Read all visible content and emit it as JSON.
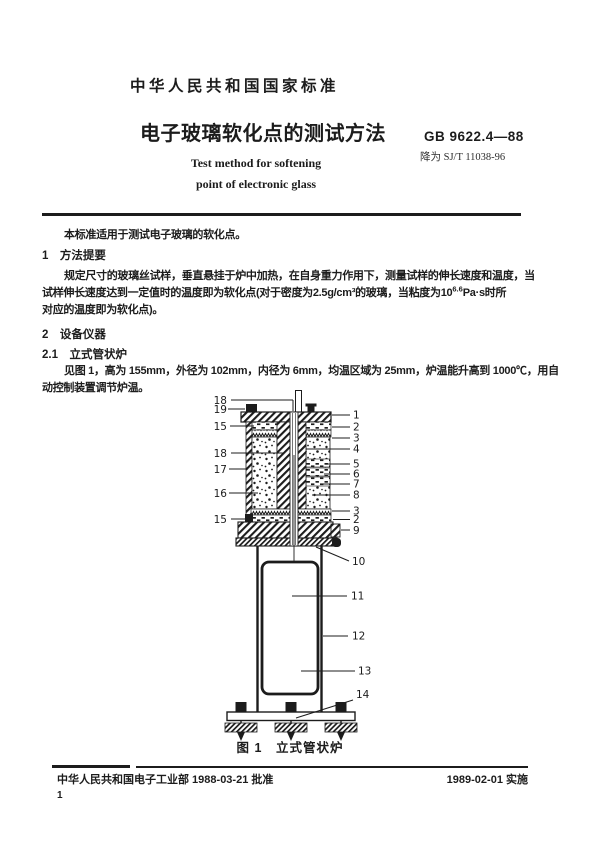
{
  "header": {
    "national_standard": "中华人民共和国国家标准",
    "title_zh": "电子玻璃软化点的测试方法",
    "title_en_line1": "Test method for softening",
    "title_en_line2": "point of electronic glass",
    "standard_code": "GB 9622.4—88",
    "superseded_note": "降为 SJ/T 11038-96"
  },
  "body": {
    "scope": "本标准适用于测试电子玻璃的软化点。",
    "section1_heading": "1　方法提要",
    "section1_line1": "规定尺寸的玻璃丝试样，垂直悬挂于炉中加热，在自身重力作用下，测量试样的伸长速度和温度，当",
    "section1_line2_pre": "试样伸长速度达到一定值时的温度即为软化点(对于密度为2.5g/cm³的玻璃，当粘度为10",
    "section1_line2_sup": "6.6",
    "section1_line2_post": "Pa·s时所",
    "section1_line3": "对应的温度即为软化点)。",
    "section2_heading": "2　设备仪器",
    "section2_1_heading": "2.1　立式管状炉",
    "section2_1_line1": "见图 1，高为 155mm，外径为 102mm，内径为 6mm，均温区域为 25mm，炉温能升高到 1000℃，用自",
    "section2_1_line2": "动控制装置调节炉温。"
  },
  "figure": {
    "caption": "图 1　立式管状炉",
    "left_labels": [
      "18",
      "19",
      "15",
      "18",
      "17",
      "16",
      "15"
    ],
    "right_labels": [
      "1",
      "2",
      "3",
      "4",
      "5",
      "6",
      "7",
      "8",
      "3",
      "2",
      "9",
      "10",
      "11",
      "12",
      "13",
      "14"
    ]
  },
  "footer": {
    "approved": "中华人民共和国电子工业部 1988-03-21 批准",
    "implemented": "1989-02-01 实施",
    "page_number": "1"
  },
  "colors": {
    "ink": "#1c1c1c",
    "paper": "#ffffff"
  }
}
